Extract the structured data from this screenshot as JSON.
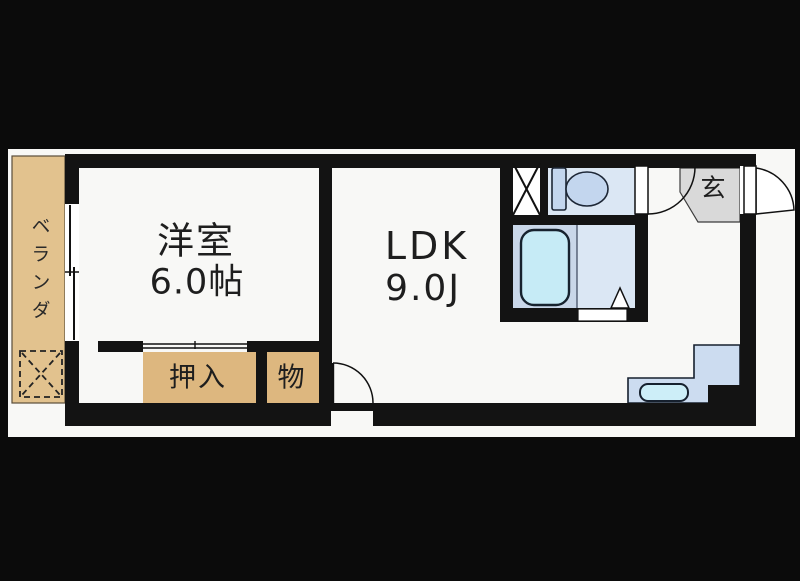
{
  "labels": {
    "balcony": "ベランダ",
    "west_room_name": "洋室",
    "west_room_size": "6.0帖",
    "ldk_name": "LDK",
    "ldk_size": "9.0J",
    "closet": "押入",
    "storage": "物",
    "entrance": "玄"
  },
  "colors": {
    "wall": "#131313",
    "plan_bg": "#f8f8f6",
    "tan": "#ddb77f",
    "balcony_tan": "#e2c28e",
    "room_blue": "#dbe7f4",
    "bath_blue": "#c9d7e9",
    "fixture_blue": "#c3d6ee",
    "tub_blue": "#c6ebf6",
    "counter_blue": "#ccdcf0",
    "sink_blue": "#cdeef8",
    "genkan_gray": "#d9d9d9"
  },
  "icons": {
    "hatch": "evacuation-hatch dashed X",
    "laundry": "washer space X",
    "toilet": "toilet tank and bowl",
    "bathtub": "rounded bathtub",
    "doors": "quarter-circle swing arcs",
    "sink": "kitchen sink"
  }
}
